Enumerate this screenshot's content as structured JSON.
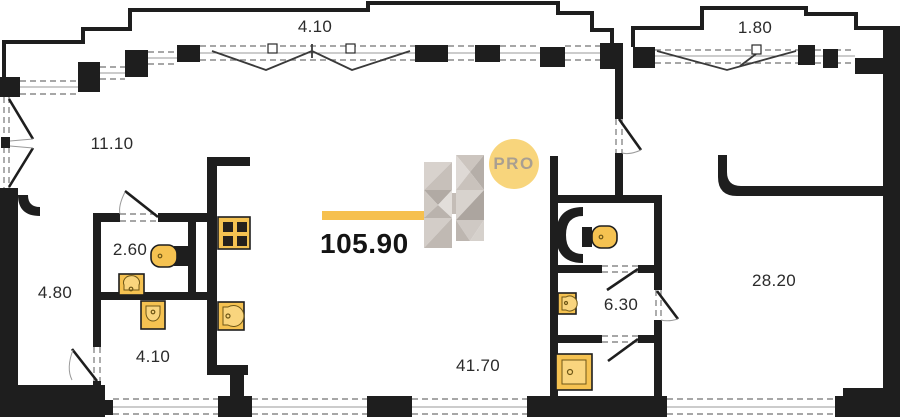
{
  "plan": {
    "labels": {
      "balcony_top": "4.10",
      "balcony_right": "1.80",
      "entry": "11.10",
      "hallway": "4.80",
      "bathroom_small": "2.60",
      "laundry": "4.10",
      "living_kitchen": "41.70",
      "bathroom_master": "6.30",
      "bedroom": "28.20",
      "total_area": "105.90",
      "logo_pro": "PRO"
    },
    "colors": {
      "wall_black": "#1E1E1E",
      "accent_yellow": "#F6C04E",
      "fixture_yellow": "#F5C251",
      "fixture_inner_yellow": "#F9D57E",
      "logo_circle_yellow": "#F8D57C",
      "logo_text_gray": "#A99F91",
      "logo_gray_light": "#D8D2CD",
      "logo_gray_dark": "#ACA59F"
    },
    "icons": [
      "stove-icon",
      "kitchen-sink-icon",
      "bathroom-sink-icon",
      "toilet-icon",
      "laundry-sink-icon",
      "master-toilet-icon",
      "master-sink-icon",
      "shower-icon"
    ]
  }
}
